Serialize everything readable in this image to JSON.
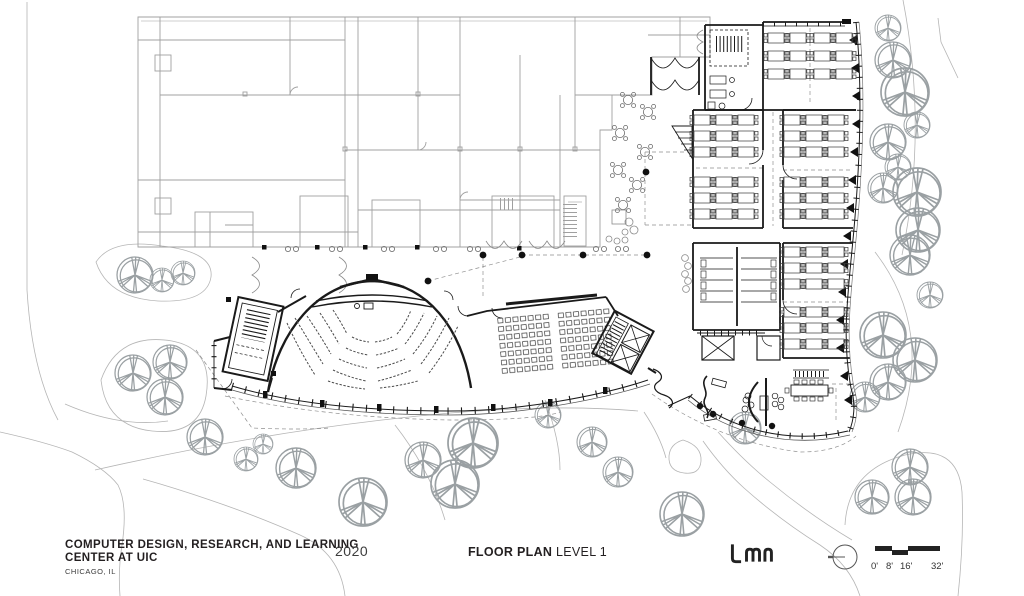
{
  "title_block": {
    "project_title_line1": "COMPUTER DESIGN, RESEARCH, AND LEARNING",
    "project_title_line2": "CENTER AT UIC",
    "location": "CHICAGO, IL",
    "year": "2020"
  },
  "sheet": {
    "label_bold": "FLOOR PLAN",
    "label_regular": "LEVEL 1"
  },
  "branding": {
    "firm_logo": "LMN"
  },
  "scale_bar": {
    "labels": [
      "0'",
      "8'",
      "16'",
      "32'"
    ]
  },
  "colors": {
    "background": "#ffffff",
    "new_wall": "#1a1a1a",
    "existing_wall": "#a0a0a0",
    "site_line": "#b5b5b5",
    "text": "#231f20"
  }
}
